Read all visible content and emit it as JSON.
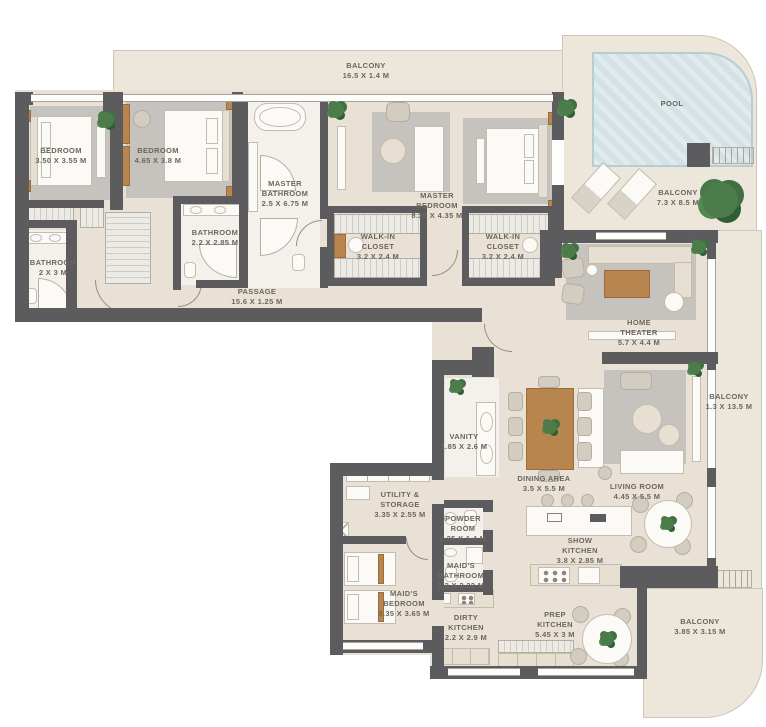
{
  "plan_title": "Apartment floor plan",
  "colors": {
    "floor": "#e9e1d5",
    "balcony_floor": "#ece6db",
    "wall": "#5c5c5e",
    "pool": "#d4e2e6",
    "plant": "#4d7c4b",
    "label_text": "#6b665d",
    "wood": "#b9854f"
  },
  "rooms": {
    "balcony_top": {
      "name": "BALCONY",
      "dims": "16.5 X 1.4 M"
    },
    "pool": {
      "name": "POOL",
      "dims": ""
    },
    "balcony_pool": {
      "name": "BALCONY",
      "dims": "7.3 X 8.5 M"
    },
    "bedroom1": {
      "name": "BEDROOM",
      "dims": "3.50 X 3.55 M"
    },
    "bedroom2": {
      "name": "BEDROOM",
      "dims": "4.65 X 3.8 M"
    },
    "master_bathroom": {
      "name": "MASTER\nBATHROOM",
      "dims": "2.5 X 6.75 M"
    },
    "bathroom1": {
      "name": "BATHROOM",
      "dims": "2 X 3 M"
    },
    "bathroom2": {
      "name": "BATHROOM",
      "dims": "2.2 X 2.85 M"
    },
    "master_bedroom": {
      "name": "MASTER\nBEDROOM",
      "dims": "8.35 X 4.35 M"
    },
    "walkin_closet_1": {
      "name": "WALK-IN\nCLOSET",
      "dims": "3.2 X 2.4 M"
    },
    "walkin_closet_2": {
      "name": "WALK-IN\nCLOSET",
      "dims": "3.2 X 2.4 M"
    },
    "passage": {
      "name": "PASSAGE",
      "dims": "15.6 X 1.25 M"
    },
    "home_theater": {
      "name": "HOME\nTHEATER",
      "dims": "5.7 X 4.4 M"
    },
    "balcony_right": {
      "name": "BALCONY",
      "dims": "1.3 X 13.5 M"
    },
    "vanity": {
      "name": "VANITY",
      "dims": "1.85 X 2.6 M"
    },
    "dining_area": {
      "name": "DINING AREA",
      "dims": "3.5 X 5.5 M"
    },
    "living_room": {
      "name": "LIVING ROOM",
      "dims": "4.45 X 5.5 M"
    },
    "utility_storage": {
      "name": "UTILITY &\nSTORAGE",
      "dims": "3.35 X 2.55 M"
    },
    "powder_room": {
      "name": "POWDER\nROOM",
      "dims": "2.25 X 1.4 M"
    },
    "maids_bathroom": {
      "name": "MAID'S\nBATHROOM",
      "dims": "1.3 X 2.22 M"
    },
    "maids_bedroom": {
      "name": "MAID'S\nBEDROOM",
      "dims": "3.35 X 3.65 M"
    },
    "dirty_kitchen": {
      "name": "DIRTY\nKITCHEN",
      "dims": "2.2 X 2.9 M"
    },
    "show_kitchen": {
      "name": "SHOW\nKITCHEN",
      "dims": "3.8 X 2.85 M"
    },
    "prep_kitchen": {
      "name": "PREP\nKITCHEN",
      "dims": "5.45 X 3 M"
    },
    "balcony_bottom": {
      "name": "BALCONY",
      "dims": "3.85 X 3.15 M"
    }
  }
}
